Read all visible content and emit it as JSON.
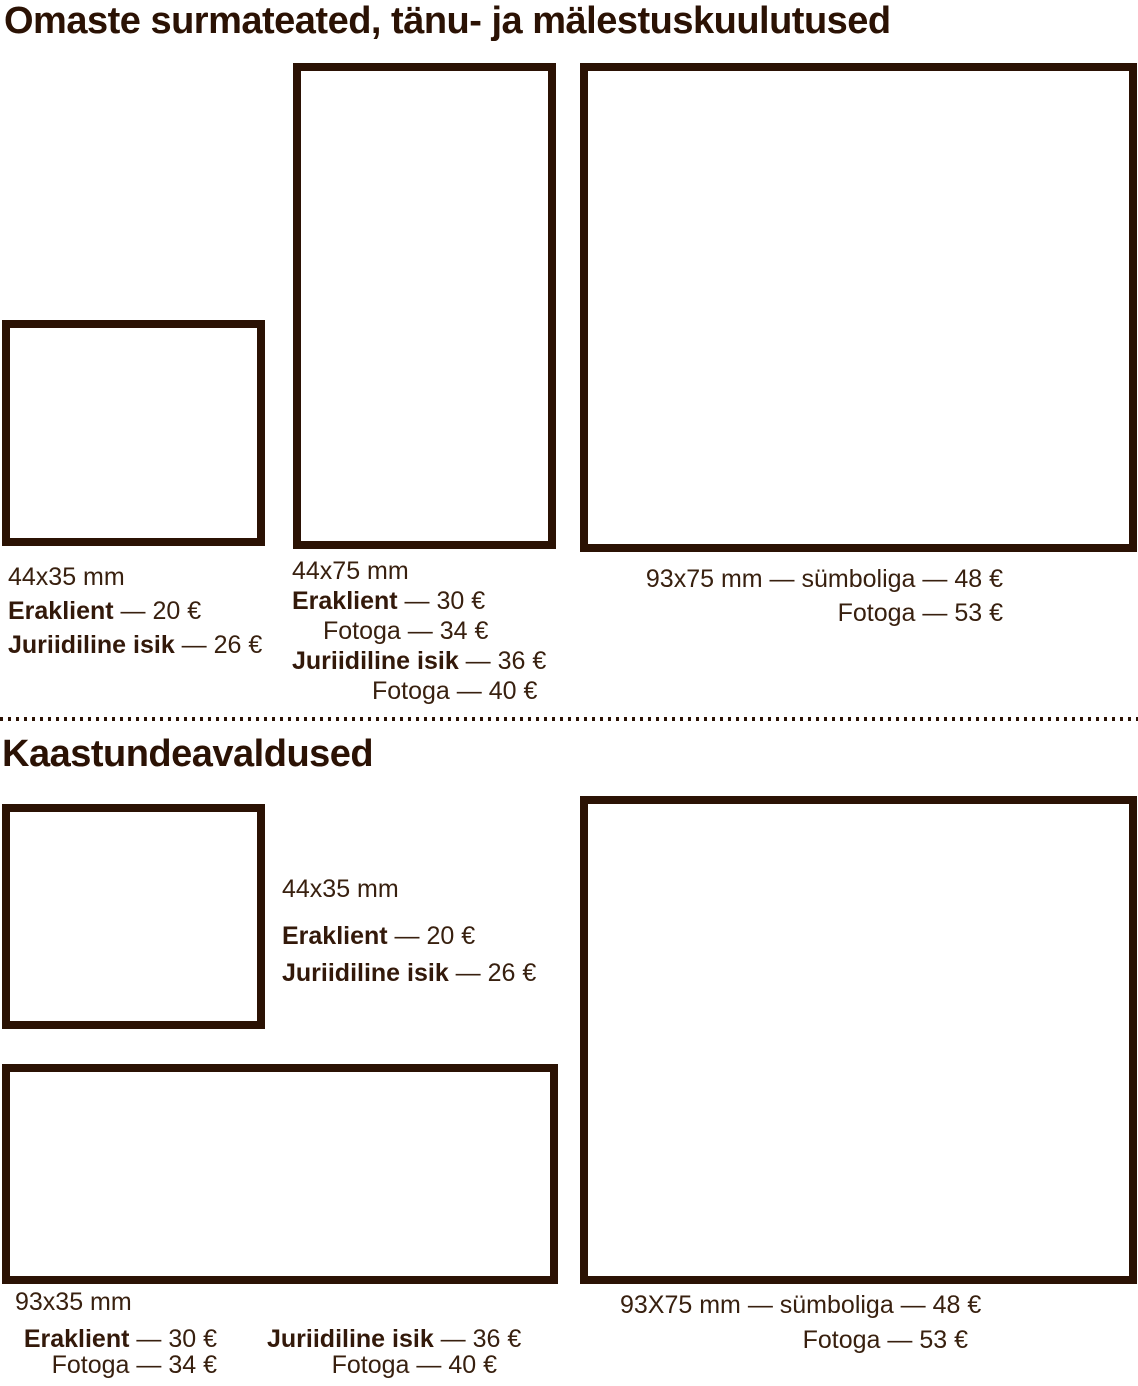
{
  "page": {
    "background": "#ffffff",
    "ink_color": "#2b1204",
    "text_color": "#38200f"
  },
  "misc": {
    "dash": " — "
  },
  "section1": {
    "title": "Omaste surmateated, tänu- ja mälestuskuulutused",
    "item1": {
      "size": "44x35 mm",
      "price1": {
        "label": "Eraklient",
        "value": "20 €"
      },
      "price2": {
        "label": "Juriidiline isik",
        "value": "26 €"
      }
    },
    "item2": {
      "size": "44x75 mm",
      "price1": {
        "label": "Eraklient",
        "value": "30 €"
      },
      "price2": {
        "label": "Fotoga",
        "value": "34 €"
      },
      "price3": {
        "label": "Juriidiline isik",
        "value": "36 €"
      },
      "price4": {
        "label": "Fotoga",
        "value": "40 €"
      }
    },
    "item3": {
      "line1": "93x75 mm — sümboliga — 48 €",
      "line2": "Fotoga — 53 €"
    }
  },
  "section2": {
    "title": "Kaastundeavaldused",
    "item1": {
      "size": "44x35 mm",
      "price1": {
        "label": "Eraklient",
        "value": "20 €"
      },
      "price2": {
        "label": "Juriidiline isik",
        "value": "26 €"
      }
    },
    "item2": {
      "size": "93x35 mm",
      "col1": {
        "price1": {
          "label": "Eraklient",
          "value": "30 €"
        },
        "price2": {
          "label": "Fotoga",
          "value": "34 €"
        }
      },
      "col2": {
        "price1": {
          "label": "Juriidiline isik",
          "value": "36 €"
        },
        "price2": {
          "label": "Fotoga",
          "value": "40 €"
        }
      }
    },
    "item3": {
      "line1": "93X75 mm — sümboliga — 48 €",
      "line2": "Fotoga — 53 €"
    }
  }
}
